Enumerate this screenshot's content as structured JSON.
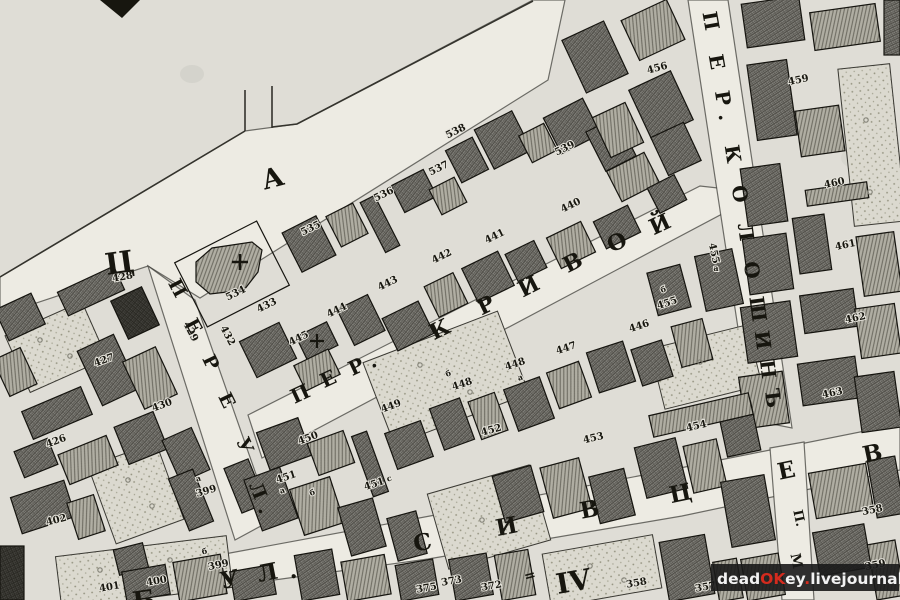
{
  "map": {
    "kind": "historical-city-plan",
    "palette": {
      "paper": "#dfddd6",
      "street": "#edebe3",
      "ink": "#17160f",
      "stone": "#7d7c75",
      "wood": "#aeaca2",
      "dark": "#3f3e3a",
      "garden": "#dbd9cf"
    },
    "streets": [
      {
        "name": "ПЕРЕУЛ.",
        "letters": [
          {
            "ch": "П",
            "x": 172,
            "y": 291,
            "r": 62,
            "s": 19
          },
          {
            "ch": "Е",
            "x": 188,
            "y": 329,
            "r": 62,
            "s": 19
          },
          {
            "ch": "Р",
            "x": 205,
            "y": 365,
            "r": 64,
            "s": 19
          },
          {
            "ch": "Е",
            "x": 221,
            "y": 403,
            "r": 64,
            "s": 19
          },
          {
            "ch": "У",
            "x": 239,
            "y": 448,
            "r": 66,
            "s": 19
          },
          {
            "ch": "Л",
            "x": 252,
            "y": 493,
            "r": 68,
            "s": 19
          },
          {
            "ch": ".",
            "x": 259,
            "y": 512,
            "r": 68,
            "s": 19
          }
        ]
      },
      {
        "name": "ПЕР. КРИВОЙ",
        "letters": [
          {
            "ch": "П",
            "x": 303,
            "y": 400,
            "r": -25,
            "s": 20
          },
          {
            "ch": "Е",
            "x": 331,
            "y": 385,
            "r": -25,
            "s": 20
          },
          {
            "ch": "Р",
            "x": 359,
            "y": 373,
            "r": -25,
            "s": 20
          },
          {
            "ch": ".",
            "x": 375,
            "y": 367,
            "r": -25,
            "s": 20
          },
          {
            "ch": "К",
            "x": 443,
            "y": 336,
            "r": -26,
            "s": 22
          },
          {
            "ch": "Р",
            "x": 489,
            "y": 312,
            "r": -26,
            "s": 22
          },
          {
            "ch": "И",
            "x": 532,
            "y": 293,
            "r": -27,
            "s": 22
          },
          {
            "ch": "В",
            "x": 576,
            "y": 269,
            "r": -27,
            "s": 22
          },
          {
            "ch": "О",
            "x": 620,
            "y": 249,
            "r": -25,
            "s": 22
          },
          {
            "ch": "Й",
            "x": 663,
            "y": 231,
            "r": -25,
            "s": 22
          }
        ]
      },
      {
        "name": "ПЕР. КОЛОШИНЪ",
        "letters": [
          {
            "ch": "П",
            "x": 704,
            "y": 22,
            "r": 80,
            "s": 20
          },
          {
            "ch": "Е",
            "x": 710,
            "y": 63,
            "r": 80,
            "s": 20
          },
          {
            "ch": "Р",
            "x": 716,
            "y": 99,
            "r": 81,
            "s": 20
          },
          {
            "ch": ".",
            "x": 719,
            "y": 118,
            "r": 81,
            "s": 20
          },
          {
            "ch": "К",
            "x": 726,
            "y": 155,
            "r": 81,
            "s": 20
          },
          {
            "ch": "О",
            "x": 733,
            "y": 195,
            "r": 81,
            "s": 20
          },
          {
            "ch": "Л",
            "x": 739,
            "y": 233,
            "r": 82,
            "s": 20
          },
          {
            "ch": "О",
            "x": 745,
            "y": 271,
            "r": 82,
            "s": 20
          },
          {
            "ch": "Ш",
            "x": 751,
            "y": 310,
            "r": 82,
            "s": 20
          },
          {
            "ch": "И",
            "x": 756,
            "y": 341,
            "r": 82,
            "s": 20
          },
          {
            "ch": "Н",
            "x": 761,
            "y": 370,
            "r": 83,
            "s": 20
          },
          {
            "ch": "Ъ",
            "x": 766,
            "y": 399,
            "r": 83,
            "s": 20
          }
        ]
      },
      {
        "name": "УЛ. СИВЦЕВ В",
        "letters": [
          {
            "ch": "У",
            "x": 231,
            "y": 587,
            "r": -11,
            "s": 23
          },
          {
            "ch": "Л",
            "x": 269,
            "y": 580,
            "r": -11,
            "s": 23
          },
          {
            "ch": ".",
            "x": 294,
            "y": 578,
            "r": -11,
            "s": 23
          },
          {
            "ch": "С",
            "x": 424,
            "y": 550,
            "r": -11,
            "s": 23
          },
          {
            "ch": "И",
            "x": 508,
            "y": 534,
            "r": -11,
            "s": 23
          },
          {
            "ch": "В",
            "x": 591,
            "y": 517,
            "r": -11,
            "s": 23
          },
          {
            "ch": "Ц",
            "x": 682,
            "y": 501,
            "r": -12,
            "s": 23
          },
          {
            "ch": "Е",
            "x": 788,
            "y": 478,
            "r": -12,
            "s": 23
          },
          {
            "ch": "В",
            "x": 874,
            "y": 461,
            "r": -12,
            "s": 23
          }
        ]
      },
      {
        "name": "П. М",
        "letters": [
          {
            "ch": "П.",
            "x": 795,
            "y": 519,
            "r": 78,
            "s": 13
          },
          {
            "ch": "М",
            "x": 792,
            "y": 562,
            "r": 78,
            "s": 14
          }
        ]
      }
    ],
    "block_letters": [
      {
        "ch": "А",
        "x": 275,
        "y": 187,
        "r": -15,
        "s": 27
      },
      {
        "ch": "Ц",
        "x": 121,
        "y": 273,
        "r": -8,
        "s": 30
      },
      {
        "ch": "IV",
        "x": 575,
        "y": 591,
        "r": -10,
        "s": 28
      },
      {
        "ch": "=",
        "x": 531,
        "y": 580,
        "r": -15,
        "s": 14
      },
      {
        "ch": "Б",
        "x": 145,
        "y": 609,
        "r": -8,
        "s": 26
      }
    ],
    "plots": [
      {
        "t": "428",
        "x": 123,
        "y": 280,
        "r": -10
      },
      {
        "t": "427",
        "x": 105,
        "y": 363,
        "r": -20
      },
      {
        "t": "426",
        "x": 57,
        "y": 444,
        "r": -20
      },
      {
        "t": "429",
        "x": 188,
        "y": 333,
        "r": 62
      },
      {
        "t": "430",
        "x": 163,
        "y": 408,
        "r": -20
      },
      {
        "t": "402",
        "x": 57,
        "y": 523,
        "r": -14
      },
      {
        "t": "399",
        "x": 207,
        "y": 494,
        "r": -16
      },
      {
        "t": "а",
        "x": 199,
        "y": 481,
        "r": -16,
        "s": 8
      },
      {
        "t": "399",
        "x": 219,
        "y": 568,
        "r": -12
      },
      {
        "t": "б",
        "x": 205,
        "y": 554,
        "r": -12,
        "s": 8
      },
      {
        "t": "400",
        "x": 157,
        "y": 584,
        "r": -10
      },
      {
        "t": "401",
        "x": 110,
        "y": 590,
        "r": -10
      },
      {
        "t": "534",
        "x": 237,
        "y": 296,
        "r": -26
      },
      {
        "t": "535",
        "x": 312,
        "y": 231,
        "r": -26
      },
      {
        "t": "536",
        "x": 385,
        "y": 197,
        "r": -26
      },
      {
        "t": "537",
        "x": 440,
        "y": 171,
        "r": -26
      },
      {
        "t": "538",
        "x": 457,
        "y": 134,
        "r": -26
      },
      {
        "t": "539",
        "x": 566,
        "y": 151,
        "r": -26
      },
      {
        "t": "440",
        "x": 572,
        "y": 208,
        "r": -26
      },
      {
        "t": "441",
        "x": 496,
        "y": 239,
        "r": -26
      },
      {
        "t": "442",
        "x": 443,
        "y": 259,
        "r": -26
      },
      {
        "t": "443",
        "x": 389,
        "y": 286,
        "r": -26
      },
      {
        "t": "444",
        "x": 338,
        "y": 313,
        "r": -26
      },
      {
        "t": "445",
        "x": 300,
        "y": 341,
        "r": -26
      },
      {
        "t": "433",
        "x": 268,
        "y": 308,
        "r": -26
      },
      {
        "t": "432",
        "x": 225,
        "y": 337,
        "r": 62
      },
      {
        "t": "456",
        "x": 658,
        "y": 71,
        "r": -15
      },
      {
        "t": "455",
        "x": 711,
        "y": 254,
        "r": 78
      },
      {
        "t": "а",
        "x": 716,
        "y": 271,
        "r": 0,
        "s": 8
      },
      {
        "t": "455",
        "x": 668,
        "y": 306,
        "r": -18
      },
      {
        "t": "б",
        "x": 664,
        "y": 292,
        "r": -18,
        "s": 8
      },
      {
        "t": "446",
        "x": 640,
        "y": 329,
        "r": -18
      },
      {
        "t": "447",
        "x": 567,
        "y": 351,
        "r": -18
      },
      {
        "t": "448",
        "x": 516,
        "y": 367,
        "r": -18
      },
      {
        "t": "а",
        "x": 521,
        "y": 380,
        "r": -18,
        "s": 8
      },
      {
        "t": "448",
        "x": 463,
        "y": 387,
        "r": -18
      },
      {
        "t": "б",
        "x": 449,
        "y": 376,
        "r": -18,
        "s": 8
      },
      {
        "t": "449",
        "x": 392,
        "y": 409,
        "r": -20
      },
      {
        "t": "450",
        "x": 309,
        "y": 441,
        "r": -20
      },
      {
        "t": "451",
        "x": 287,
        "y": 480,
        "r": -18
      },
      {
        "t": "а",
        "x": 283,
        "y": 493,
        "r": -18,
        "s": 8
      },
      {
        "t": "б",
        "x": 313,
        "y": 495,
        "r": -18,
        "s": 8
      },
      {
        "t": "451",
        "x": 375,
        "y": 487,
        "r": -18
      },
      {
        "t": "с",
        "x": 390,
        "y": 481,
        "r": -18,
        "s": 8
      },
      {
        "t": "452",
        "x": 492,
        "y": 433,
        "r": -15
      },
      {
        "t": "453",
        "x": 594,
        "y": 441,
        "r": -13
      },
      {
        "t": "454",
        "x": 697,
        "y": 429,
        "r": -13
      },
      {
        "t": "459",
        "x": 799,
        "y": 83,
        "r": -12
      },
      {
        "t": "460",
        "x": 835,
        "y": 186,
        "r": -12
      },
      {
        "t": "461",
        "x": 846,
        "y": 248,
        "r": -12
      },
      {
        "t": "462",
        "x": 856,
        "y": 321,
        "r": -12
      },
      {
        "t": "463",
        "x": 833,
        "y": 396,
        "r": -12
      },
      {
        "t": "375",
        "x": 427,
        "y": 591,
        "r": -10
      },
      {
        "t": "373",
        "x": 452,
        "y": 584,
        "r": -10
      },
      {
        "t": "372",
        "x": 492,
        "y": 589,
        "r": -10
      },
      {
        "t": "358",
        "x": 637,
        "y": 586,
        "r": -10
      },
      {
        "t": "357",
        "x": 706,
        "y": 590,
        "r": -10
      },
      {
        "t": "358",
        "x": 873,
        "y": 513,
        "r": -12
      },
      {
        "t": "359",
        "x": 876,
        "y": 568,
        "r": -12
      }
    ],
    "watermark": {
      "parts": [
        {
          "text": "dead",
          "color": "#f2f2f2"
        },
        {
          "text": "OK",
          "color": "#d42b1e"
        },
        {
          "text": "ey",
          "color": "#f2f2f2"
        },
        {
          "text": ".",
          "color": "#d42b1e"
        },
        {
          "text": "livejournal",
          "color": "#f2f2f2"
        },
        {
          "text": ".",
          "color": "#d42b1e"
        },
        {
          "text": "com",
          "color": "#f2f2f2"
        }
      ]
    }
  }
}
